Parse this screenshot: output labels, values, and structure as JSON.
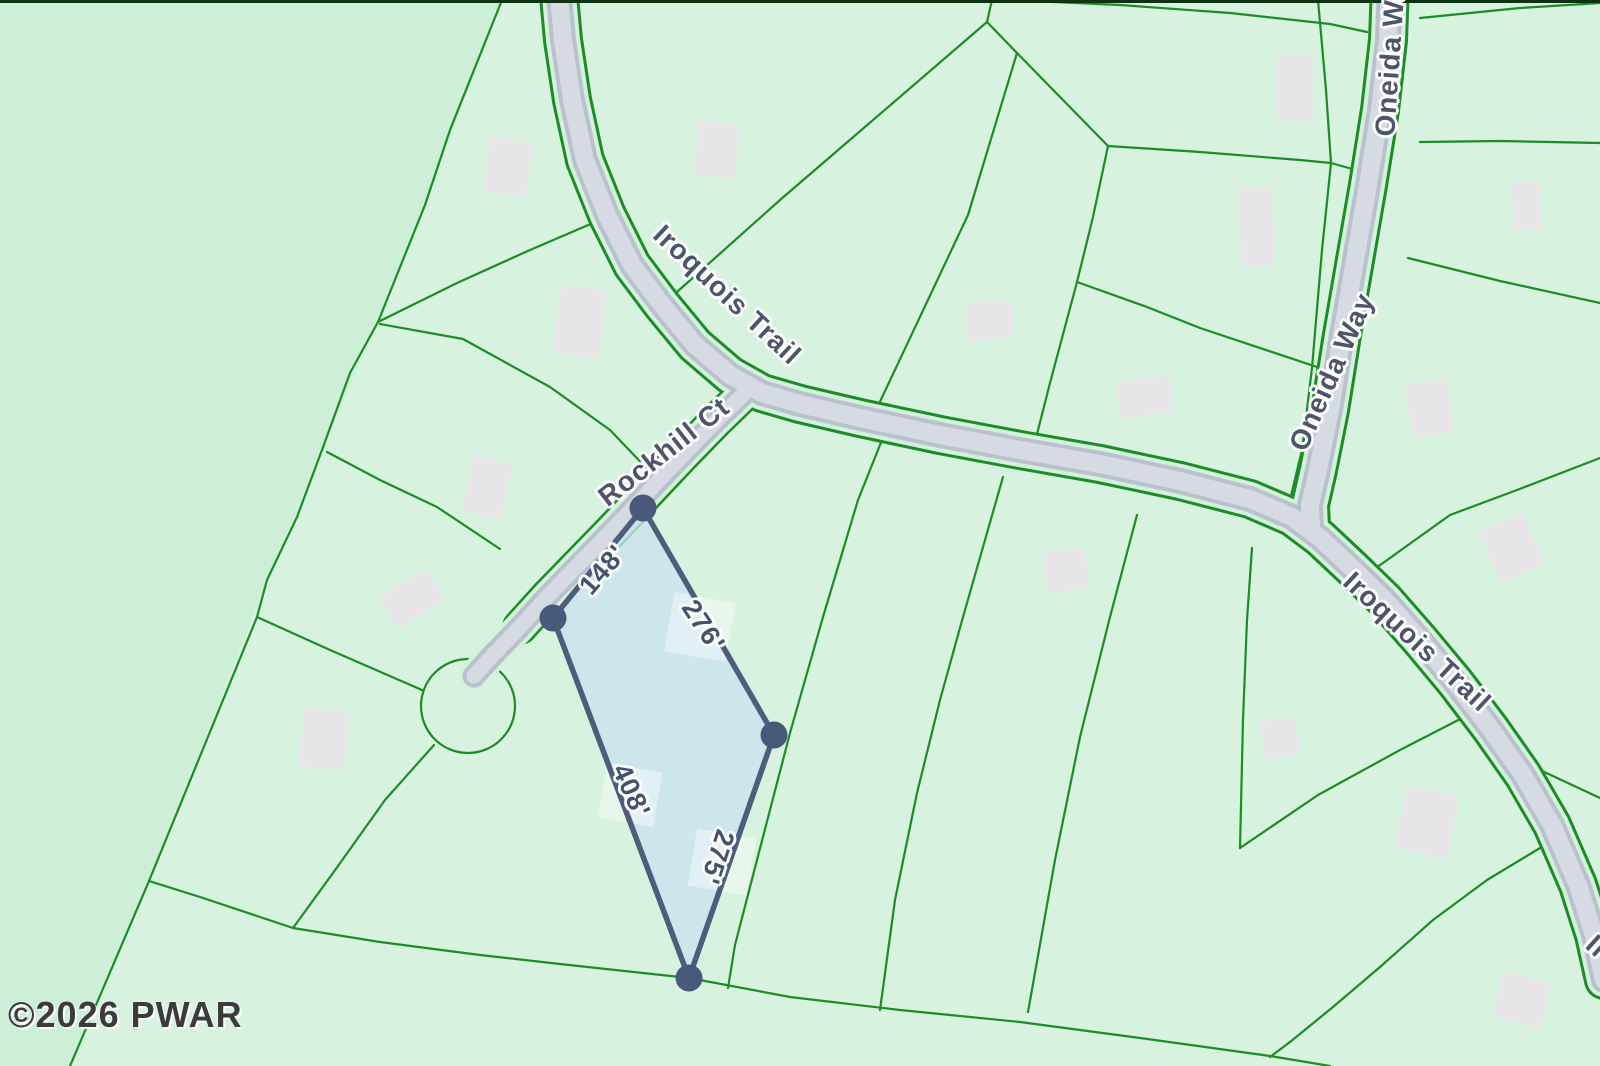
{
  "watermark": {
    "text": "©2026 PWAR"
  },
  "road_labels": [
    {
      "text": "Iroquois Trail",
      "x": 727,
      "y": 295,
      "rot": 43
    },
    {
      "text": "Rockhill Ct",
      "x": 664,
      "y": 452,
      "rot": -38
    },
    {
      "text": "Iroquois Trail",
      "x": 1417,
      "y": 642,
      "rot": 43
    },
    {
      "text": "Oneida Way",
      "x": 1332,
      "y": 372,
      "rot": -66
    },
    {
      "text": "Oneida Way",
      "x": 1391,
      "y": 52,
      "rot": -86
    },
    {
      "text": "Iroquois",
      "x": 1634,
      "y": 980,
      "rot": 42
    }
  ],
  "dimension_labels": [
    {
      "text": "148'",
      "x": 603,
      "y": 570,
      "rot": -49
    },
    {
      "text": "276'",
      "x": 703,
      "y": 626,
      "rot": 57
    },
    {
      "text": "408'",
      "x": 631,
      "y": 791,
      "rot": 66
    },
    {
      "text": "275'",
      "x": 717,
      "y": 857,
      "rot": 108
    }
  ],
  "map": {
    "width": 1600,
    "height": 1066,
    "colors": {
      "map_bg": "#cdefd8",
      "tint": "rgba(255,255,255,0.20)",
      "parcel_line": "#1c8c24",
      "road_gap": "#d3f1dc",
      "road_casing": "#b9c1cc",
      "road_fill": "#d6dae2",
      "building": "#e8e5e8",
      "lot_fill": "rgba(201,227,240,0.78)",
      "lot_patch": "rgba(255,255,255,0.42)",
      "lot_border": "#4d5d7b",
      "lot_dot": "#49597a",
      "dim_text": "#44536d",
      "road_text": "#4c5569",
      "watermark_text": "#3b3b3b",
      "top_strip": "#0d3312"
    },
    "tint_region": "502,0 425,205 378,322 322,450 267,580 149,881 70,1066 1600,1066 1600,0",
    "top_strip": {
      "x": 0,
      "y": 0,
      "w": 1600,
      "h": 3
    },
    "subject_parcel": {
      "vertices": "643,508 774,735 689,978 553,618",
      "corner_dots": [
        {
          "x": 643,
          "y": 508
        },
        {
          "x": 774,
          "y": 735
        },
        {
          "x": 689,
          "y": 978
        },
        {
          "x": 553,
          "y": 618
        }
      ],
      "dot_radius": 13.5,
      "border_width": 5.5,
      "side_lengths_ft": [
        148,
        276,
        408,
        275
      ],
      "patches": [
        {
          "x": 700,
          "y": 627,
          "w": 62,
          "h": 60,
          "r": 10
        },
        {
          "x": 630,
          "y": 795,
          "w": 56,
          "h": 55,
          "r": 10
        },
        {
          "x": 722,
          "y": 862,
          "w": 60,
          "h": 58,
          "r": 10
        }
      ]
    },
    "culdesac": {
      "cx": 468,
      "cy": 706,
      "r": 47
    },
    "boundary_line_width": 2.2,
    "boundary_lines": [
      "502,0 450,130 425,205 378,322",
      "378,322 457,283 530,250 600,220",
      "378,322 350,373 322,450 297,517 267,580 257,617 149,881 70,1066",
      "380,324 463,339 550,387 610,430 655,477",
      "327,452 380,480 437,507 500,549",
      "257,617 330,650 422,690",
      "434,745 385,800 333,873 293,928",
      "149,881 200,897 293,928",
      "293,928 380,942 480,955 560,964 689,978 790,997 900,1010 1020,1022 1140,1038 1270,1056 1330,1066",
      "668,300 780,200 987,22 992,0",
      "987,22 1017,53",
      "1017,53 968,215 877,408",
      "1017,53 1108,146",
      "1108,146 1200,152 1300,160 1331,163 1363,172",
      "1108,146 1093,217 1077,282",
      "1077,282 1147,307 1200,328 1320,368",
      "1077,282 1050,383 1035,442",
      "1318,0 1326,90 1331,163 1322,250 1312,368 1302,450 1290,500 1280,505",
      "1010,0 1120,5 1230,13 1330,24 1367,32",
      "1420,142 1500,141 1600,143",
      "1408,258 1500,281 1600,303",
      "1420,18 1520,8 1600,3",
      "1376,568 1450,515 1517,490 1600,458",
      "882,440 858,500 823,617 790,733 757,860 735,945 728,988",
      "1003,477 987,533 963,617 940,700 917,793 895,900 880,1010",
      "1137,515 1110,617 1080,737 1055,860 1028,1012",
      "1252,548 1247,620 1243,720 1240,848",
      "1240,848 1318,795 1400,750 1468,715",
      "1540,770 1600,798",
      "1545,845 1487,880 1433,920 1380,967 1333,1007 1290,1042 1270,1057"
    ],
    "roads": [
      {
        "name": "iroquois-trail",
        "points": "558,-15 563,40 572,100 585,160 607,215 632,265 662,305 695,345 730,375 762,393 800,404 860,418 940,435 1020,450 1100,464 1180,481 1250,499 1292,517 1320,538 1352,568 1385,600 1420,640 1455,682 1490,728 1523,775 1552,825 1578,885 1594,935 1604,980",
        "w_edge": 40,
        "w_bg": 34,
        "w_casing": 26,
        "w_fill": 18
      },
      {
        "name": "oneida-way",
        "points": "1390,-15 1388,40 1380,110 1368,185 1355,260 1342,335 1330,410 1318,470 1310,505 1311,528",
        "w_edge": 40,
        "w_bg": 34,
        "w_casing": 26,
        "w_fill": 18
      },
      {
        "name": "rockhill-ct",
        "points": "747,391 716,421 682,456 648,492 614,528 580,563 548,596 518,629 492,656 474,676",
        "flank_points": "747,391 716,421 682,456 648,492 614,528 580,563 548,596 520,627",
        "w_edge": 36,
        "w_bg": 31,
        "w_casing": 23,
        "w_fill": 15
      }
    ],
    "buildings": [
      {
        "x": 508,
        "y": 167,
        "w": 43,
        "h": 54,
        "r": 10
      },
      {
        "x": 580,
        "y": 322,
        "w": 46,
        "h": 68,
        "r": 8
      },
      {
        "x": 487,
        "y": 487,
        "w": 40,
        "h": 56,
        "r": 14
      },
      {
        "x": 412,
        "y": 599,
        "w": 56,
        "h": 36,
        "r": -33
      },
      {
        "x": 324,
        "y": 739,
        "w": 45,
        "h": 58,
        "r": 8
      },
      {
        "x": 717,
        "y": 150,
        "w": 40,
        "h": 54,
        "r": 3
      },
      {
        "x": 990,
        "y": 320,
        "w": 46,
        "h": 38,
        "r": -2
      },
      {
        "x": 1145,
        "y": 397,
        "w": 54,
        "h": 36,
        "r": -8
      },
      {
        "x": 1295,
        "y": 88,
        "w": 36,
        "h": 66,
        "r": 0
      },
      {
        "x": 1257,
        "y": 227,
        "w": 33,
        "h": 78,
        "r": -2
      },
      {
        "x": 1527,
        "y": 206,
        "w": 27,
        "h": 48,
        "r": -4
      },
      {
        "x": 1430,
        "y": 408,
        "w": 42,
        "h": 54,
        "r": -8
      },
      {
        "x": 1066,
        "y": 570,
        "w": 42,
        "h": 40,
        "r": -8
      },
      {
        "x": 1512,
        "y": 548,
        "w": 48,
        "h": 56,
        "r": -25
      },
      {
        "x": 1280,
        "y": 738,
        "w": 36,
        "h": 37,
        "r": -10
      },
      {
        "x": 1427,
        "y": 822,
        "w": 53,
        "h": 63,
        "r": 12
      },
      {
        "x": 1522,
        "y": 1000,
        "w": 49,
        "h": 46,
        "r": 15
      }
    ]
  }
}
